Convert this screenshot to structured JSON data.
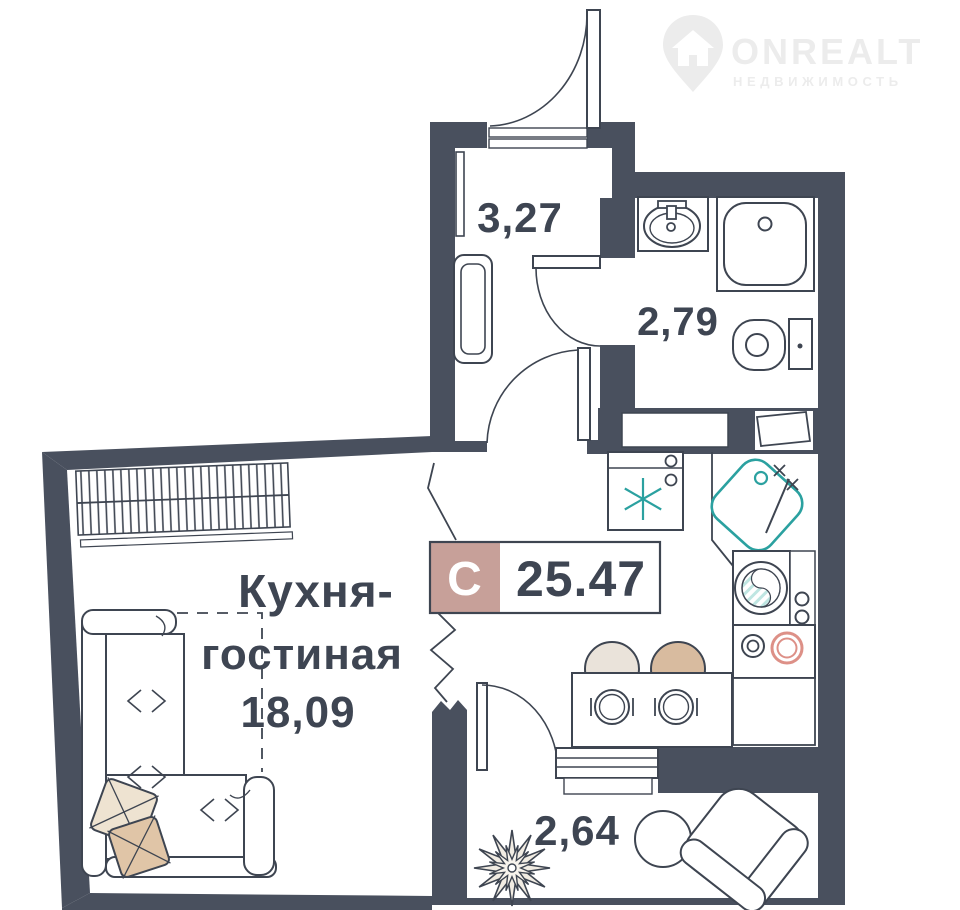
{
  "watermark": {
    "brand": "ONREALT",
    "subtitle": "НЕДВИЖИМОСТЬ"
  },
  "badge": {
    "type_letter": "С",
    "total_area": "25.47"
  },
  "rooms": {
    "hallway": {
      "area": "3,27"
    },
    "bathroom": {
      "area": "2,79"
    },
    "kitchen_living": {
      "name_line1": "Кухня-",
      "name_line2": "гостиная",
      "area": "18,09"
    },
    "balcony": {
      "area": "2,64"
    }
  },
  "colors": {
    "wall": "#49505e",
    "line": "#3e4551",
    "label": "#3e4552",
    "teal": "#2ba1a0",
    "teal_light": "#bfe6e2",
    "badge_rose": "#c7a099",
    "stove_coral": "#dd9087",
    "watermark": "#ececec"
  }
}
